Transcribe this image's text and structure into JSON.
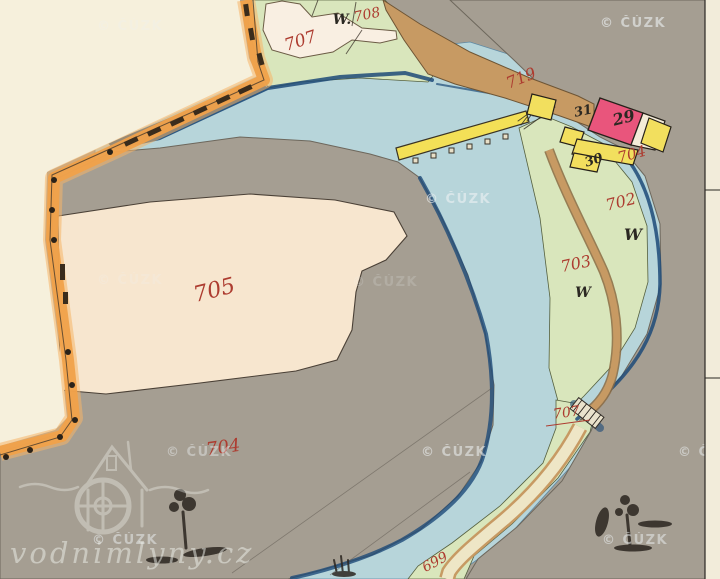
{
  "watermark": {
    "text": "© ČÚZK"
  },
  "site_watermark": {
    "text": "vodnimlyny.cz"
  },
  "labels": [
    {
      "name": "parcel-707",
      "text": "707",
      "color": "red"
    },
    {
      "name": "meadow-708-w",
      "text": "W.",
      "color": "black"
    },
    {
      "name": "parcel-708",
      "text": "708",
      "color": "red"
    },
    {
      "name": "road-719",
      "text": "719",
      "color": "red"
    },
    {
      "name": "house-31",
      "text": "31",
      "color": "black"
    },
    {
      "name": "house-29",
      "text": "29",
      "color": "black"
    },
    {
      "name": "house-30",
      "text": "30",
      "color": "black"
    },
    {
      "name": "parcel-704-mill",
      "text": "704",
      "color": "red"
    },
    {
      "name": "parcel-702",
      "text": "702",
      "color": "red"
    },
    {
      "name": "meadow-702-w",
      "text": "W",
      "color": "black"
    },
    {
      "name": "parcel-703",
      "text": "703",
      "color": "red"
    },
    {
      "name": "meadow-703-w",
      "text": "W",
      "color": "black"
    },
    {
      "name": "parcel-707-bridge",
      "text": "707",
      "color": "red"
    },
    {
      "name": "parcel-705",
      "text": "705",
      "color": "red"
    },
    {
      "name": "parcel-704",
      "text": "704",
      "color": "red"
    },
    {
      "name": "road-699",
      "text": "699",
      "color": "red"
    }
  ],
  "colors": {
    "paper_outside": "#f6f0dc",
    "field_gray": "#a59e92",
    "gray_shade": "#7d7264",
    "water": "#b7d5da",
    "water_dark": "#1d4a78",
    "meadow_green": "#d9e6bc",
    "parcel_pink": "#f7e6cf",
    "parcel_small_pink": "#f9efe2",
    "boundary_orange": "#f0a14a",
    "boundary_orange_halo": "#f6b468",
    "road_tan": "#c79a63",
    "road_edge": "#8a6a42",
    "road_fill_light": "#eee6c6",
    "weir_yellow": "#f3e057",
    "building_pink": "#e9557c",
    "building_yellow": "#f2df5e",
    "building_white": "#f4ecd8",
    "ink": "#2b2620",
    "label_red": "#ad3c30",
    "label_black": "#2b2822",
    "margin_paper": "#f2ecda",
    "watermark": "#eef2f4"
  }
}
